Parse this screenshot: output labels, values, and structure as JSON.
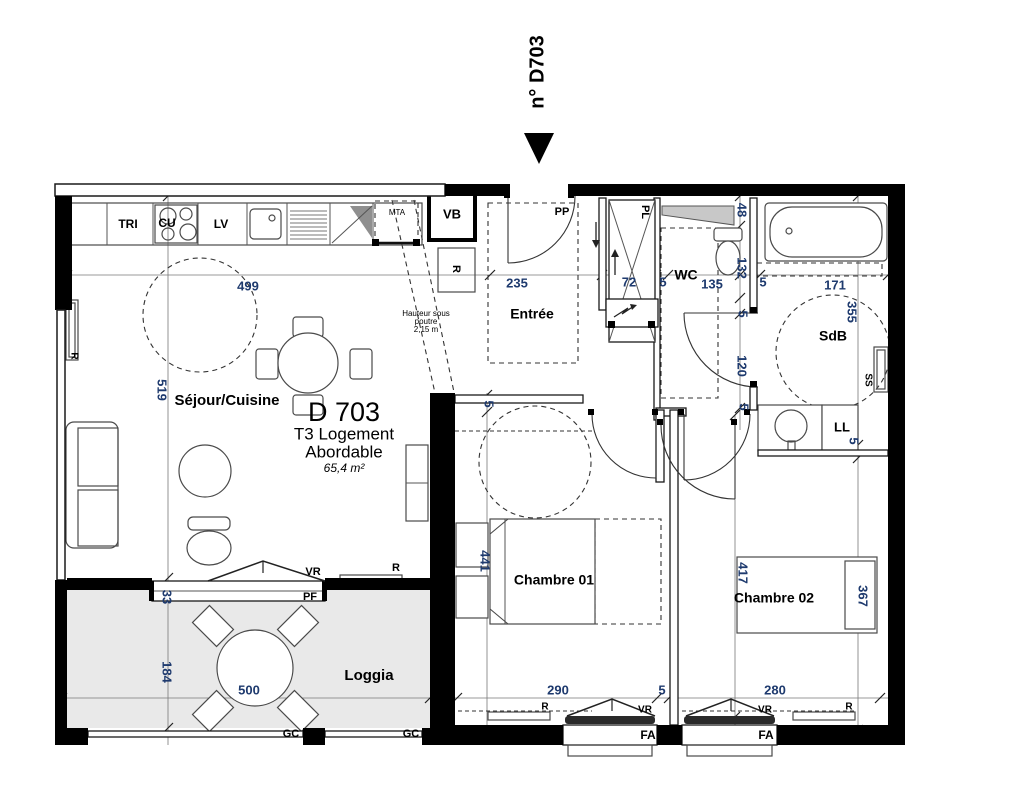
{
  "unit_tag": "n° D703",
  "title_block": {
    "id": "D 703",
    "line1": "T3 Logement",
    "line2": "Abordable",
    "area": "65,4 m²"
  },
  "rooms": {
    "sejour": "Séjour/Cuisine",
    "entree": "Entrée",
    "wc": "WC",
    "sdb": "SdB",
    "chambre1": "Chambre 01",
    "chambre2": "Chambre 02",
    "loggia": "Loggia"
  },
  "beam_note": {
    "line1": "Hauteur sous",
    "line2": "poutre",
    "line3": "2,15 m"
  },
  "equipment": {
    "tri": "TRI",
    "cu": "CU",
    "lv": "LV",
    "mta": "MTA",
    "vb": "VB",
    "pp": "PP",
    "pl": "PL",
    "pf": "PF",
    "vr": "VR",
    "fa": "FA",
    "gc": "GC",
    "ll": "LL",
    "ss": "SS",
    "r": "R"
  },
  "dims": {
    "d499": "499",
    "d235": "235",
    "d72": "72",
    "d135": "135",
    "d171": "171",
    "d48": "48",
    "d132": "132",
    "d120": "120",
    "d355": "355",
    "d519": "519",
    "d33": "33",
    "d184": "184",
    "d500": "500",
    "d441": "441",
    "d417": "417",
    "d367": "367",
    "d290": "290",
    "d280": "280",
    "d5": "5"
  },
  "colors": {
    "wall": "#000000",
    "loggia_floor": "#e9e9e9",
    "dim_text": "#1e3a6e"
  }
}
